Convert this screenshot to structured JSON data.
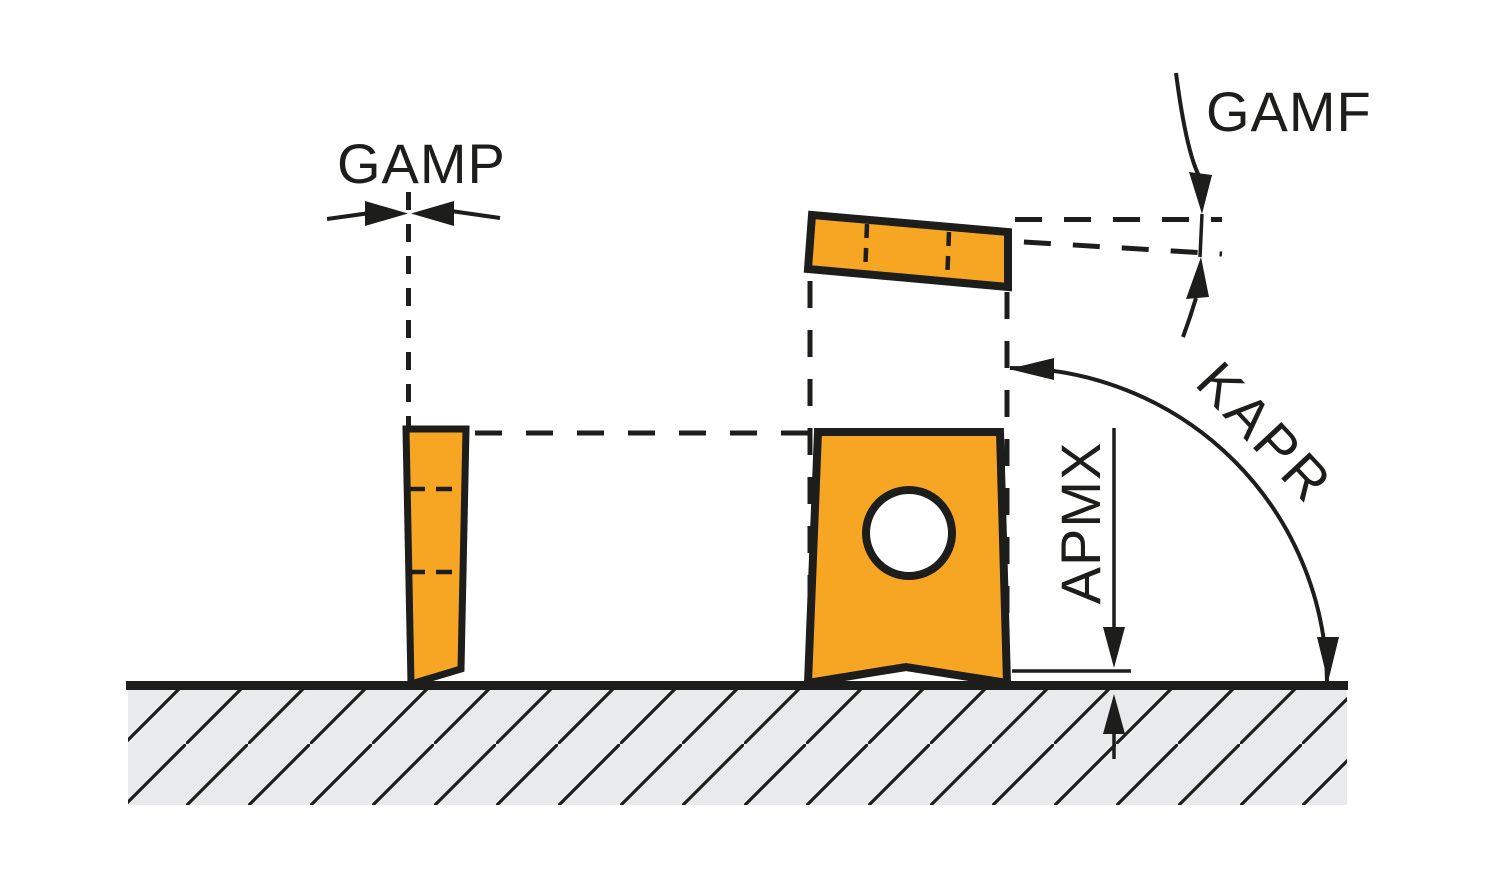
{
  "labels": {
    "gamp": "GAMP",
    "gamf": "GAMF",
    "kapr": "KAPR",
    "apmx": "APMX"
  },
  "colors": {
    "insert_fill": "#F6A623",
    "line_color": "#1D1D1B",
    "surface_fill": "#E9EAEB",
    "background": "#FFFFFF"
  }
}
